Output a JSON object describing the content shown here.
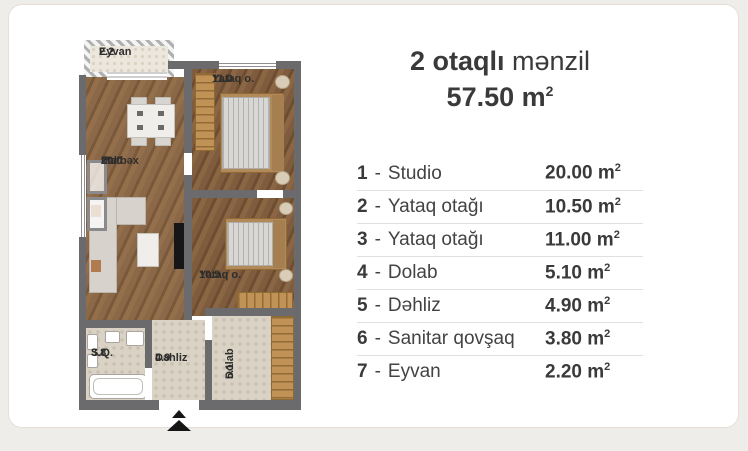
{
  "header": {
    "title_bold": "2 otaqlı",
    "title_rest": "mənzil",
    "total_area": "57.50"
  },
  "units": {
    "base": "m",
    "exp": "2"
  },
  "legend": {
    "dash": "-",
    "rows": [
      {
        "num": "1",
        "name": "Studio",
        "area": "20.00"
      },
      {
        "num": "2",
        "name": "Yataq otağı",
        "area": "10.50"
      },
      {
        "num": "3",
        "name": "Yataq otağı",
        "area": "11.00"
      },
      {
        "num": "4",
        "name": "Dolab",
        "area": "5.10"
      },
      {
        "num": "5",
        "name": "Dəhliz",
        "area": "4.90"
      },
      {
        "num": "6",
        "name": "Sanitar qovşaq",
        "area": "3.80"
      },
      {
        "num": "7",
        "name": "Eyvan",
        "area": "2.20"
      }
    ]
  },
  "plan": {
    "rooms": {
      "eyvan": {
        "name": "Eyvan",
        "area": "2.2"
      },
      "bed1": {
        "name": "Yataq o.",
        "area": "11.0"
      },
      "zal": {
        "line1": "Zal",
        "line2": "Matbəx",
        "area": "20.0"
      },
      "bed2": {
        "name": "Yataq o.",
        "area": "10.5"
      },
      "sq": {
        "name": "S.Q.",
        "area": "3.8"
      },
      "dehliz": {
        "name": "Dəhliz",
        "area": "4.9"
      },
      "dolab": {
        "name": "Dolab",
        "area": "5.1"
      }
    }
  },
  "colors": {
    "page_bg": "#efedea",
    "card_bg": "#ffffff",
    "wall": "#6b6a6c",
    "wood_living": "#8a6848",
    "wood_bedroom": "#7f5c3d",
    "tile": "#d9d2c5",
    "wardrobe_wood": "#c09256",
    "text": "#3a3a3a",
    "divider": "#e0e0e0"
  }
}
